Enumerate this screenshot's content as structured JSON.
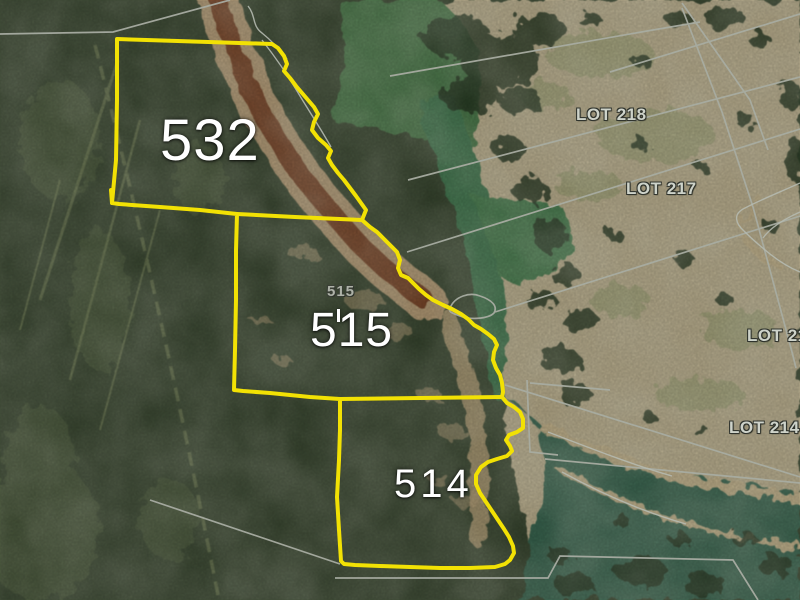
{
  "map": {
    "parcels": [
      {
        "label": "532"
      },
      {
        "label": "515"
      },
      {
        "label": "514"
      }
    ],
    "small_parcel_label": "515",
    "lots": [
      {
        "label": "LOT 218"
      },
      {
        "label": "LOT 217"
      },
      {
        "label": "LOT 21"
      },
      {
        "label": "LOT 214"
      }
    ],
    "colors": {
      "parcel_boundary": "#f2e104",
      "cadastral_line": "#a8aca2",
      "creek_line": "#b5bab0",
      "parcel_label": "#ffffff",
      "lot_label": "#ced3ca"
    }
  }
}
